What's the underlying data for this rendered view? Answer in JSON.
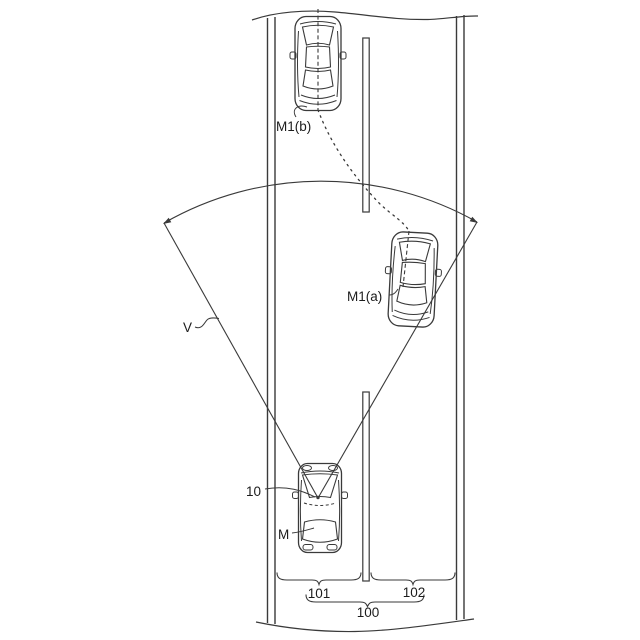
{
  "figure": {
    "kind": "patent-style road diagram",
    "background_color": "#ffffff",
    "line_color": "#3a3a3a",
    "text_color": "#1c1c1c"
  },
  "labels": {
    "vehicle_ahead_far": "M1(b)",
    "vehicle_ahead_near": "M1(a)",
    "field_of_view": "V",
    "sensor": "10",
    "ego_vehicle": "M",
    "lane_left": "101",
    "lane_right": "102",
    "road": "100"
  }
}
